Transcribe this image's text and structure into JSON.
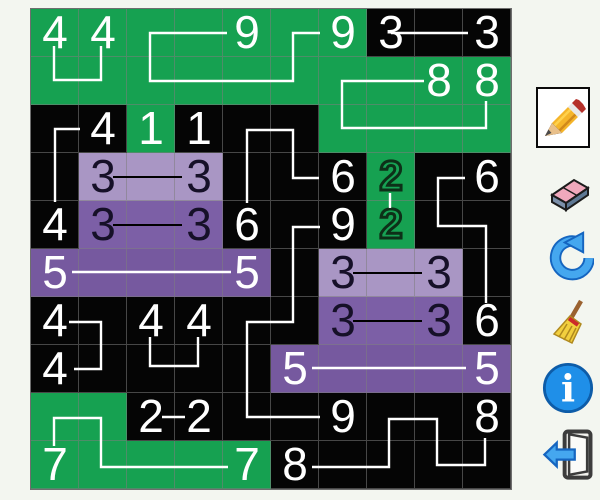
{
  "app": {
    "background": "#f3f6f0"
  },
  "board": {
    "origin": {
      "x": 30,
      "y": 8
    },
    "cell_size": 48,
    "rows": 10,
    "cols": 10,
    "colors": {
      "green": "#16a151",
      "black": "#050505",
      "light_purple": "#a996c4",
      "dark_purple": "#7c5fa6",
      "deep_purple": "#76599f",
      "grid_line": "rgba(125,125,125,0.55)",
      "white_path": "#ffffff",
      "black_path": "#000000"
    },
    "cell_colors": [
      "GGGGGGGKKK",
      "GGGGGGGGGG",
      "KKGKKKGGGG",
      "KLLLKKKGKK",
      "KDDDKKKGKK",
      "PPPPPKLLLK",
      "KKKKKKDDDK",
      "KKKKKPPPPP",
      "GGKKKKKKKK",
      "GGGGGKKKKK"
    ],
    "clues": [
      {
        "r": 0,
        "c": 0,
        "value": "4",
        "style": "white"
      },
      {
        "r": 0,
        "c": 1,
        "value": "4",
        "style": "white"
      },
      {
        "r": 0,
        "c": 4,
        "value": "9",
        "style": "white"
      },
      {
        "r": 0,
        "c": 6,
        "value": "9",
        "style": "white"
      },
      {
        "r": 0,
        "c": 7,
        "value": "3",
        "style": "white"
      },
      {
        "r": 0,
        "c": 9,
        "value": "3",
        "style": "white"
      },
      {
        "r": 1,
        "c": 8,
        "value": "8",
        "style": "white"
      },
      {
        "r": 1,
        "c": 9,
        "value": "8",
        "style": "white"
      },
      {
        "r": 2,
        "c": 1,
        "value": "4",
        "style": "white"
      },
      {
        "r": 2,
        "c": 2,
        "value": "1",
        "style": "white"
      },
      {
        "r": 2,
        "c": 3,
        "value": "1",
        "style": "white"
      },
      {
        "r": 3,
        "c": 1,
        "value": "3",
        "style": "dark"
      },
      {
        "r": 3,
        "c": 3,
        "value": "3",
        "style": "dark"
      },
      {
        "r": 3,
        "c": 6,
        "value": "6",
        "style": "white"
      },
      {
        "r": 3,
        "c": 7,
        "value": "2",
        "style": "outlined"
      },
      {
        "r": 3,
        "c": 9,
        "value": "6",
        "style": "white"
      },
      {
        "r": 4,
        "c": 0,
        "value": "4",
        "style": "white"
      },
      {
        "r": 4,
        "c": 1,
        "value": "3",
        "style": "dark"
      },
      {
        "r": 4,
        "c": 3,
        "value": "3",
        "style": "dark"
      },
      {
        "r": 4,
        "c": 4,
        "value": "6",
        "style": "white"
      },
      {
        "r": 4,
        "c": 6,
        "value": "9",
        "style": "white"
      },
      {
        "r": 4,
        "c": 7,
        "value": "2",
        "style": "outlined"
      },
      {
        "r": 5,
        "c": 0,
        "value": "5",
        "style": "white"
      },
      {
        "r": 5,
        "c": 4,
        "value": "5",
        "style": "white"
      },
      {
        "r": 5,
        "c": 6,
        "value": "3",
        "style": "dark"
      },
      {
        "r": 5,
        "c": 8,
        "value": "3",
        "style": "dark"
      },
      {
        "r": 6,
        "c": 0,
        "value": "4",
        "style": "white"
      },
      {
        "r": 6,
        "c": 2,
        "value": "4",
        "style": "white"
      },
      {
        "r": 6,
        "c": 3,
        "value": "4",
        "style": "white"
      },
      {
        "r": 6,
        "c": 6,
        "value": "3",
        "style": "dark"
      },
      {
        "r": 6,
        "c": 8,
        "value": "3",
        "style": "dark"
      },
      {
        "r": 6,
        "c": 9,
        "value": "6",
        "style": "white"
      },
      {
        "r": 7,
        "c": 0,
        "value": "4",
        "style": "white"
      },
      {
        "r": 7,
        "c": 5,
        "value": "5",
        "style": "white"
      },
      {
        "r": 7,
        "c": 9,
        "value": "5",
        "style": "white"
      },
      {
        "r": 8,
        "c": 2,
        "value": "2",
        "style": "white"
      },
      {
        "r": 8,
        "c": 3,
        "value": "2",
        "style": "white"
      },
      {
        "r": 8,
        "c": 6,
        "value": "9",
        "style": "white"
      },
      {
        "r": 8,
        "c": 9,
        "value": "8",
        "style": "white"
      },
      {
        "r": 9,
        "c": 0,
        "value": "7",
        "style": "white"
      },
      {
        "r": 9,
        "c": 4,
        "value": "7",
        "style": "white"
      },
      {
        "r": 9,
        "c": 5,
        "value": "8",
        "style": "white"
      }
    ],
    "paths": [
      {
        "pair": "4-4 top",
        "color": "#ffffff",
        "width": 2.4,
        "points": [
          [
            54,
            46
          ],
          [
            54,
            80
          ],
          [
            101,
            80
          ],
          [
            101,
            46
          ]
        ]
      },
      {
        "pair": "9-9 top",
        "color": "#ffffff",
        "width": 2.4,
        "points": [
          [
            227,
            33
          ],
          [
            150,
            33
          ],
          [
            150,
            81
          ],
          [
            293,
            81
          ],
          [
            293,
            33
          ],
          [
            320,
            33
          ]
        ]
      },
      {
        "pair": "3-3 top",
        "color": "#ffffff",
        "width": 2.4,
        "points": [
          [
            391,
            33
          ],
          [
            468,
            33
          ]
        ]
      },
      {
        "pair": "8-8 upper",
        "color": "#ffffff",
        "width": 2.4,
        "points": [
          [
            424,
            81
          ],
          [
            342,
            81
          ],
          [
            342,
            128
          ],
          [
            486,
            128
          ],
          [
            486,
            101
          ]
        ]
      },
      {
        "pair": "4-4 left",
        "color": "#ffffff",
        "width": 2.4,
        "points": [
          [
            80,
            129
          ],
          [
            55,
            129
          ],
          [
            55,
            202
          ]
        ]
      },
      {
        "pair": "6-6 middle",
        "color": "#ffffff",
        "width": 2.4,
        "points": [
          [
            319,
            178
          ],
          [
            293,
            178
          ],
          [
            293,
            130
          ],
          [
            247,
            130
          ],
          [
            247,
            203
          ]
        ]
      },
      {
        "pair": "6-6 right",
        "color": "#ffffff",
        "width": 2.4,
        "points": [
          [
            465,
            178
          ],
          [
            438,
            178
          ],
          [
            438,
            226
          ],
          [
            486,
            226
          ],
          [
            486,
            303
          ]
        ]
      },
      {
        "pair": "2-2 green dash",
        "color": "#ffffff",
        "width": 2.4,
        "points": [
          [
            390,
            193
          ],
          [
            390,
            208
          ]
        ]
      },
      {
        "pair": "5-5 row5",
        "color": "#ffffff",
        "width": 2.4,
        "points": [
          [
            72,
            272
          ],
          [
            231,
            272
          ]
        ]
      },
      {
        "pair": "4-4 rows6-7",
        "color": "#ffffff",
        "width": 2.4,
        "points": [
          [
            69,
            322
          ],
          [
            101,
            322
          ],
          [
            101,
            369
          ],
          [
            74,
            369
          ]
        ]
      },
      {
        "pair": "4-4 row6",
        "color": "#ffffff",
        "width": 2.4,
        "points": [
          [
            150,
            337
          ],
          [
            150,
            366
          ],
          [
            198,
            366
          ],
          [
            198,
            337
          ]
        ]
      },
      {
        "pair": "9-9 long",
        "color": "#ffffff",
        "width": 2.4,
        "points": [
          [
            320,
            227
          ],
          [
            293,
            227
          ],
          [
            293,
            322
          ],
          [
            247,
            322
          ],
          [
            247,
            417
          ],
          [
            320,
            417
          ]
        ]
      },
      {
        "pair": "2-2 row8 dash",
        "color": "#ffffff",
        "width": 2.4,
        "points": [
          [
            162,
            417
          ],
          [
            185,
            417
          ]
        ]
      },
      {
        "pair": "7-7 bottom",
        "color": "#ffffff",
        "width": 2.4,
        "points": [
          [
            54,
            446
          ],
          [
            54,
            418
          ],
          [
            101,
            418
          ],
          [
            101,
            467
          ],
          [
            228,
            467
          ]
        ]
      },
      {
        "pair": "8-8 bottom",
        "color": "#ffffff",
        "width": 2.4,
        "points": [
          [
            312,
            467
          ],
          [
            389,
            467
          ],
          [
            389,
            419
          ],
          [
            437,
            419
          ],
          [
            437,
            465
          ],
          [
            485,
            465
          ],
          [
            485,
            438
          ]
        ]
      },
      {
        "pair": "5-5 row7",
        "color": "#ffffff",
        "width": 2.4,
        "points": [
          [
            312,
            368
          ],
          [
            466,
            368
          ]
        ]
      },
      {
        "pair": "3-3 row3",
        "color": "#000000",
        "width": 2,
        "points": [
          [
            113,
            177
          ],
          [
            182,
            177
          ]
        ]
      },
      {
        "pair": "3-3 row4",
        "color": "#000000",
        "width": 2,
        "points": [
          [
            113,
            225
          ],
          [
            182,
            225
          ]
        ]
      },
      {
        "pair": "3-3 row5",
        "color": "#000000",
        "width": 2,
        "points": [
          [
            353,
            273
          ],
          [
            422,
            273
          ]
        ]
      },
      {
        "pair": "3-3 row6",
        "color": "#000000",
        "width": 2,
        "points": [
          [
            353,
            321
          ],
          [
            422,
            321
          ]
        ]
      }
    ]
  },
  "toolbar": {
    "tools": [
      {
        "id": "pencil",
        "icon": "pencil-icon",
        "selected": true
      },
      {
        "id": "eraser",
        "icon": "eraser-icon",
        "selected": false
      },
      {
        "id": "undo",
        "icon": "undo-icon",
        "selected": false
      },
      {
        "id": "clean",
        "icon": "broom-icon",
        "selected": false
      },
      {
        "id": "info",
        "icon": "info-icon",
        "selected": false
      },
      {
        "id": "exit",
        "icon": "exit-door-icon",
        "selected": false
      }
    ],
    "info_glyph": "i"
  }
}
